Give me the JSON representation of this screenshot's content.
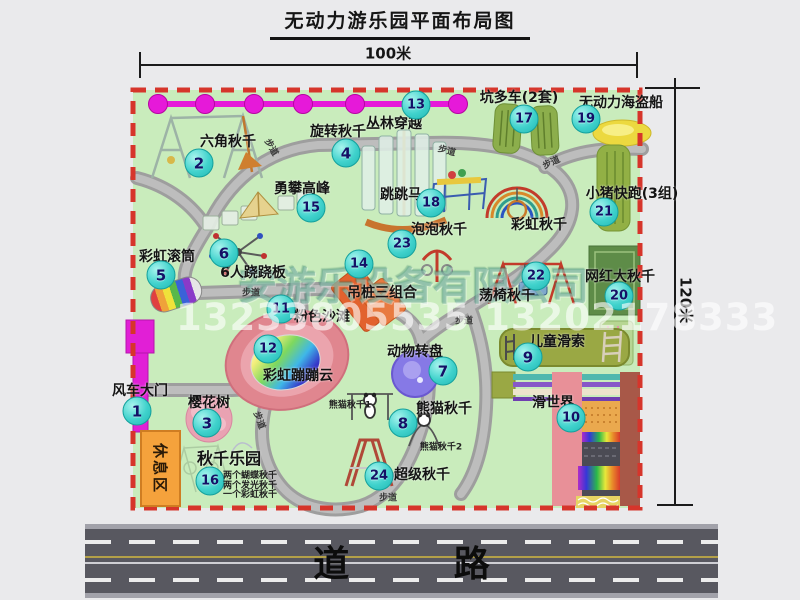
{
  "title": "无动力游乐园平面布局图",
  "dims": {
    "width": "100米",
    "height": "120米"
  },
  "watermarks": {
    "company": "安游乐设备有限公司",
    "phone": "13233805535 13202178333"
  },
  "road_label": "道 路",
  "rest_area_label": "休息区",
  "trail_label": "步道",
  "colors": {
    "map_green": "#c9ecbc",
    "border_red": "#d6352b",
    "badge_cyan": "#40d2cc",
    "zipline_magenta": "#e619d9",
    "gate_magenta": "#e11fd6",
    "rest_area_orange": "#f5a23c",
    "road_gray": "#585860"
  },
  "attractions": [
    {
      "num": "1",
      "name": "风车大门",
      "nx": 140,
      "ny": 390,
      "bx": 137,
      "by": 411
    },
    {
      "num": "2",
      "name": "六角秋千",
      "nx": 228,
      "ny": 141,
      "bx": 199,
      "by": 163
    },
    {
      "num": "3",
      "name": "樱花树",
      "nx": 209,
      "ny": 402,
      "bx": 207,
      "by": 423
    },
    {
      "num": "4",
      "name": "旋转秋千",
      "nx": 338,
      "ny": 131,
      "bx": 346,
      "by": 153
    },
    {
      "num": "5",
      "name": "彩虹滚筒",
      "nx": 167,
      "ny": 256,
      "bx": 161,
      "by": 275
    },
    {
      "num": "6",
      "name": "6人跷跷板",
      "nx": 253,
      "ny": 272,
      "bx": 224,
      "by": 253
    },
    {
      "num": "7",
      "name": "动物转盘",
      "nx": 415,
      "ny": 351,
      "bx": 443,
      "by": 371
    },
    {
      "num": "8",
      "name": "熊猫秋千",
      "nx": 444,
      "ny": 408,
      "bx": 403,
      "by": 423
    },
    {
      "num": "9",
      "name": "儿童滑索",
      "nx": 557,
      "ny": 341,
      "bx": 528,
      "by": 357
    },
    {
      "num": "10",
      "name": "滑世界",
      "nx": 553,
      "ny": 402,
      "bx": 571,
      "by": 418
    },
    {
      "num": "11",
      "name": "粉色沙滩",
      "nx": 322,
      "ny": 316,
      "bx": 281,
      "by": 309
    },
    {
      "num": "12",
      "name": "彩虹蹦蹦云",
      "nx": 298,
      "ny": 375,
      "bx": 268,
      "by": 349
    },
    {
      "num": "13",
      "name": "丛林穿越",
      "nx": 394,
      "ny": 123,
      "bx": 416,
      "by": 105
    },
    {
      "num": "14",
      "name": "吊桩三组合",
      "nx": 382,
      "ny": 292,
      "bx": 359,
      "by": 264
    },
    {
      "num": "15",
      "name": "勇攀高峰",
      "nx": 302,
      "ny": 188,
      "bx": 311,
      "by": 208
    },
    {
      "num": "16",
      "name": "秋千乐园",
      "nx": 229,
      "ny": 457,
      "fs": 16,
      "bx": 210,
      "by": 481
    },
    {
      "num": "17",
      "name": "坑多车(2套)",
      "nx": 519,
      "ny": 97,
      "bx": 524,
      "by": 119
    },
    {
      "num": "18",
      "name": "跳跳马",
      "nx": 401,
      "ny": 194,
      "bx": 431,
      "by": 203
    },
    {
      "num": "19",
      "name": "无动力海盗船",
      "nx": 621,
      "ny": 102,
      "bx": 586,
      "by": 119
    },
    {
      "num": "20",
      "name": "网红大秋千",
      "nx": 620,
      "ny": 276,
      "bx": 619,
      "by": 296
    },
    {
      "num": "21",
      "name": "小猪快跑(3组)",
      "nx": 632,
      "ny": 193,
      "bx": 604,
      "by": 212
    },
    {
      "num": "22",
      "name": "荡椅秋千",
      "nx": 507,
      "ny": 295,
      "bx": 536,
      "by": 276
    },
    {
      "num": "23",
      "name": "泡泡秋千",
      "nx": 439,
      "ny": 229,
      "bx": 402,
      "by": 244
    },
    {
      "num": "24",
      "name": "超级秋千",
      "nx": 422,
      "ny": 474,
      "bx": 379,
      "by": 476
    }
  ],
  "unnumbered_labels": [
    {
      "name": "彩虹秋千",
      "x": 539,
      "y": 224
    }
  ],
  "small_labels": [
    {
      "text": "熊猫秋千1",
      "x": 350,
      "y": 404
    },
    {
      "text": "熊猫秋千2",
      "x": 441,
      "y": 446
    }
  ],
  "swing_park_notes": [
    "两个蝴蝶秋千",
    "两个发光秋千",
    "一个彩虹秋千"
  ],
  "trails": [
    {
      "x": 272,
      "y": 147,
      "r": 60
    },
    {
      "x": 447,
      "y": 150,
      "r": 15
    },
    {
      "x": 551,
      "y": 162,
      "r": -25
    },
    {
      "x": 251,
      "y": 292,
      "r": 0
    },
    {
      "x": 464,
      "y": 320,
      "r": 0
    },
    {
      "x": 260,
      "y": 420,
      "r": 70
    },
    {
      "x": 388,
      "y": 497,
      "r": 0
    }
  ]
}
